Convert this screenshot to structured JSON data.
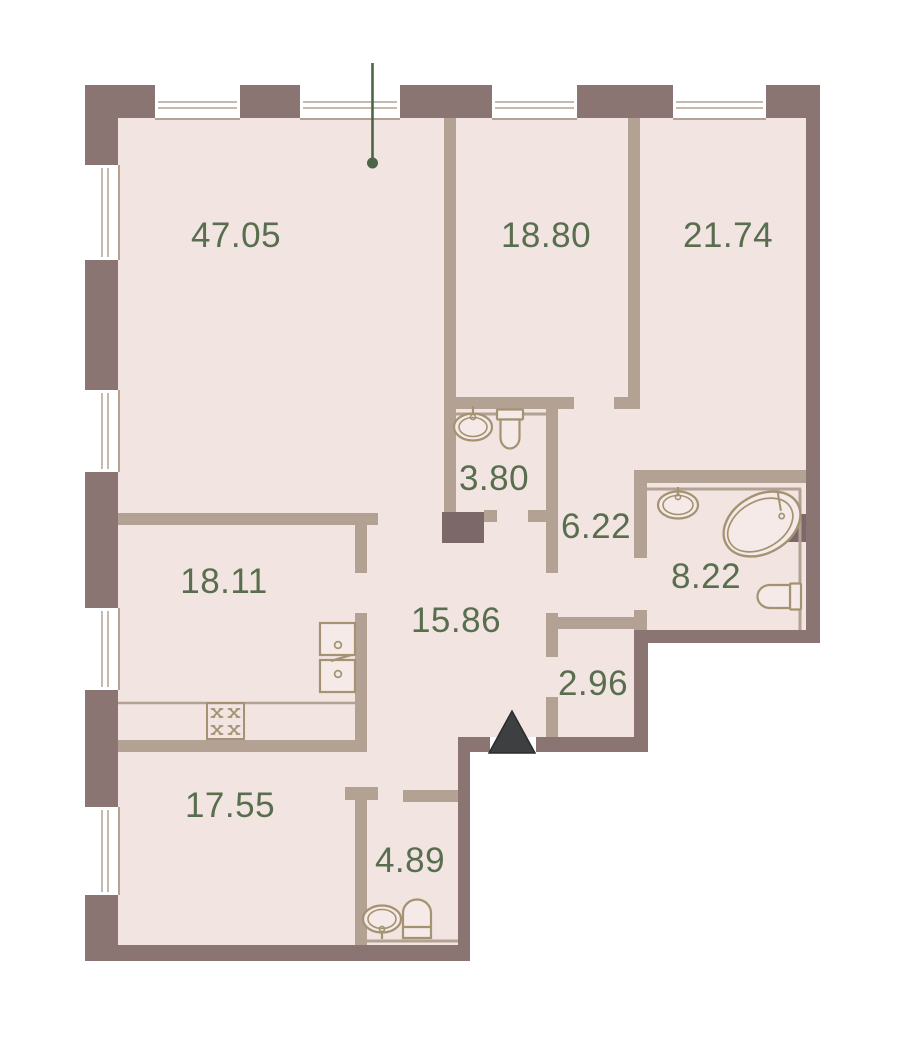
{
  "plan": {
    "title": "Apartment floor plan",
    "colors": {
      "exterior_wall": "#8b7572",
      "interior_wall": "#b3a294",
      "floor": "#f1e4e1",
      "shaft": "#7c6868",
      "label_text": "#586e4e",
      "marker_green": "#4d6547",
      "entrance_arrow": "#3e3f41",
      "fixture_outline": "#a49372",
      "background": "#ffffff"
    },
    "rooms": [
      {
        "id": "living-room",
        "area": "47.05"
      },
      {
        "id": "bedroom-top",
        "area": "18.80"
      },
      {
        "id": "bedroom-right",
        "area": "21.74"
      },
      {
        "id": "wc-small",
        "area": "3.80"
      },
      {
        "id": "corridor",
        "area": "6.22"
      },
      {
        "id": "bathroom-main",
        "area": "8.22"
      },
      {
        "id": "kitchen",
        "area": "18.11"
      },
      {
        "id": "hallway",
        "area": "15.86"
      },
      {
        "id": "storage",
        "area": "2.96"
      },
      {
        "id": "bedroom-bottom",
        "area": "17.55"
      },
      {
        "id": "bathroom-guest",
        "area": "4.89"
      }
    ],
    "fixtures": [
      "sink",
      "toilet",
      "bathtub",
      "stove",
      "kitchen-sink-cabinet",
      "counter",
      "duct-shaft",
      "entrance-arrow",
      "leader-pin-marker",
      "window"
    ]
  }
}
